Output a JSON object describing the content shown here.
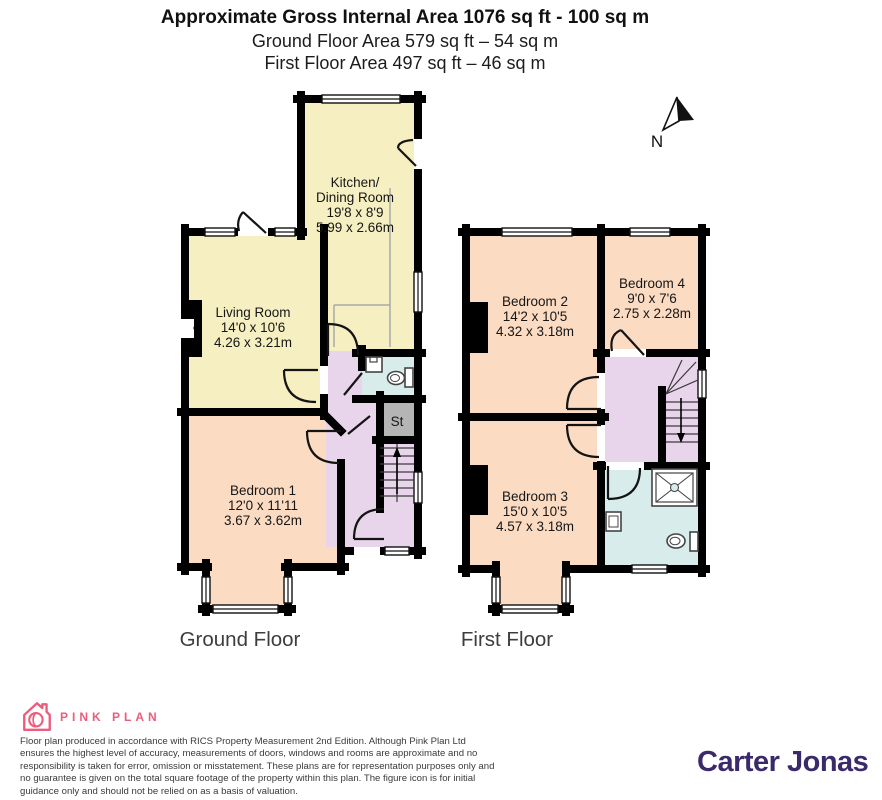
{
  "header": {
    "title": "Approximate Gross Internal Area 1076 sq ft - 100 sq m",
    "subtitle_ground": "Ground Floor Area 579 sq ft – 54 sq m",
    "subtitle_first": "First Floor Area 497 sq ft – 46 sq m"
  },
  "compass": {
    "north_label": "N"
  },
  "ground_floor": {
    "caption": "Ground Floor",
    "rooms": {
      "kitchen_dining": {
        "lines": [
          "Kitchen/",
          "Dining Room",
          "19'8 x 8'9",
          "5.99 x 2.66m"
        ]
      },
      "living_room": {
        "lines": [
          "Living Room",
          "14'0 x 10'6",
          "4.26 x 3.21m"
        ]
      },
      "bedroom_1": {
        "lines": [
          "Bedroom 1",
          "12'0 x 11'11",
          "3.67 x 3.62m"
        ]
      },
      "store": {
        "label": "St"
      }
    }
  },
  "first_floor": {
    "caption": "First Floor",
    "rooms": {
      "bedroom_2": {
        "lines": [
          "Bedroom 2",
          "14'2 x 10'5",
          "4.32 x 3.18m"
        ]
      },
      "bedroom_3": {
        "lines": [
          "Bedroom 3",
          "15'0 x 10'5",
          "4.57 x 3.18m"
        ]
      },
      "bedroom_4": {
        "lines": [
          "Bedroom 4",
          "9'0 x 7'6",
          "2.75 x 2.28m"
        ]
      }
    }
  },
  "footer": {
    "producer_brand": "PINK PLAN",
    "disclaimer": "Floor plan produced in accordance with RICS Property Measurement 2nd Edition. Although Pink Plan Ltd ensures the highest level of accuracy, measurements of doors, windows and rooms are approximate and no responsibility is taken for error, omission or misstatement. These plans are for representation purposes only and no guarantee is given on the total square footage of the property within this plan. The figure icon is for initial guidance only and should not be relied on as a basis of valuation.",
    "agent_brand": "Carter Jonas"
  },
  "colors": {
    "room_yellow": "#f6efc2",
    "room_peach": "#fbdcc2",
    "hall_lilac": "#e8d4eb",
    "bath_blue": "#d9ecec",
    "store_grey": "#b5b5b5",
    "wall_black": "#000000",
    "brand_pink": "#ec5c7c",
    "brand_purple": "#3b2a6b"
  }
}
